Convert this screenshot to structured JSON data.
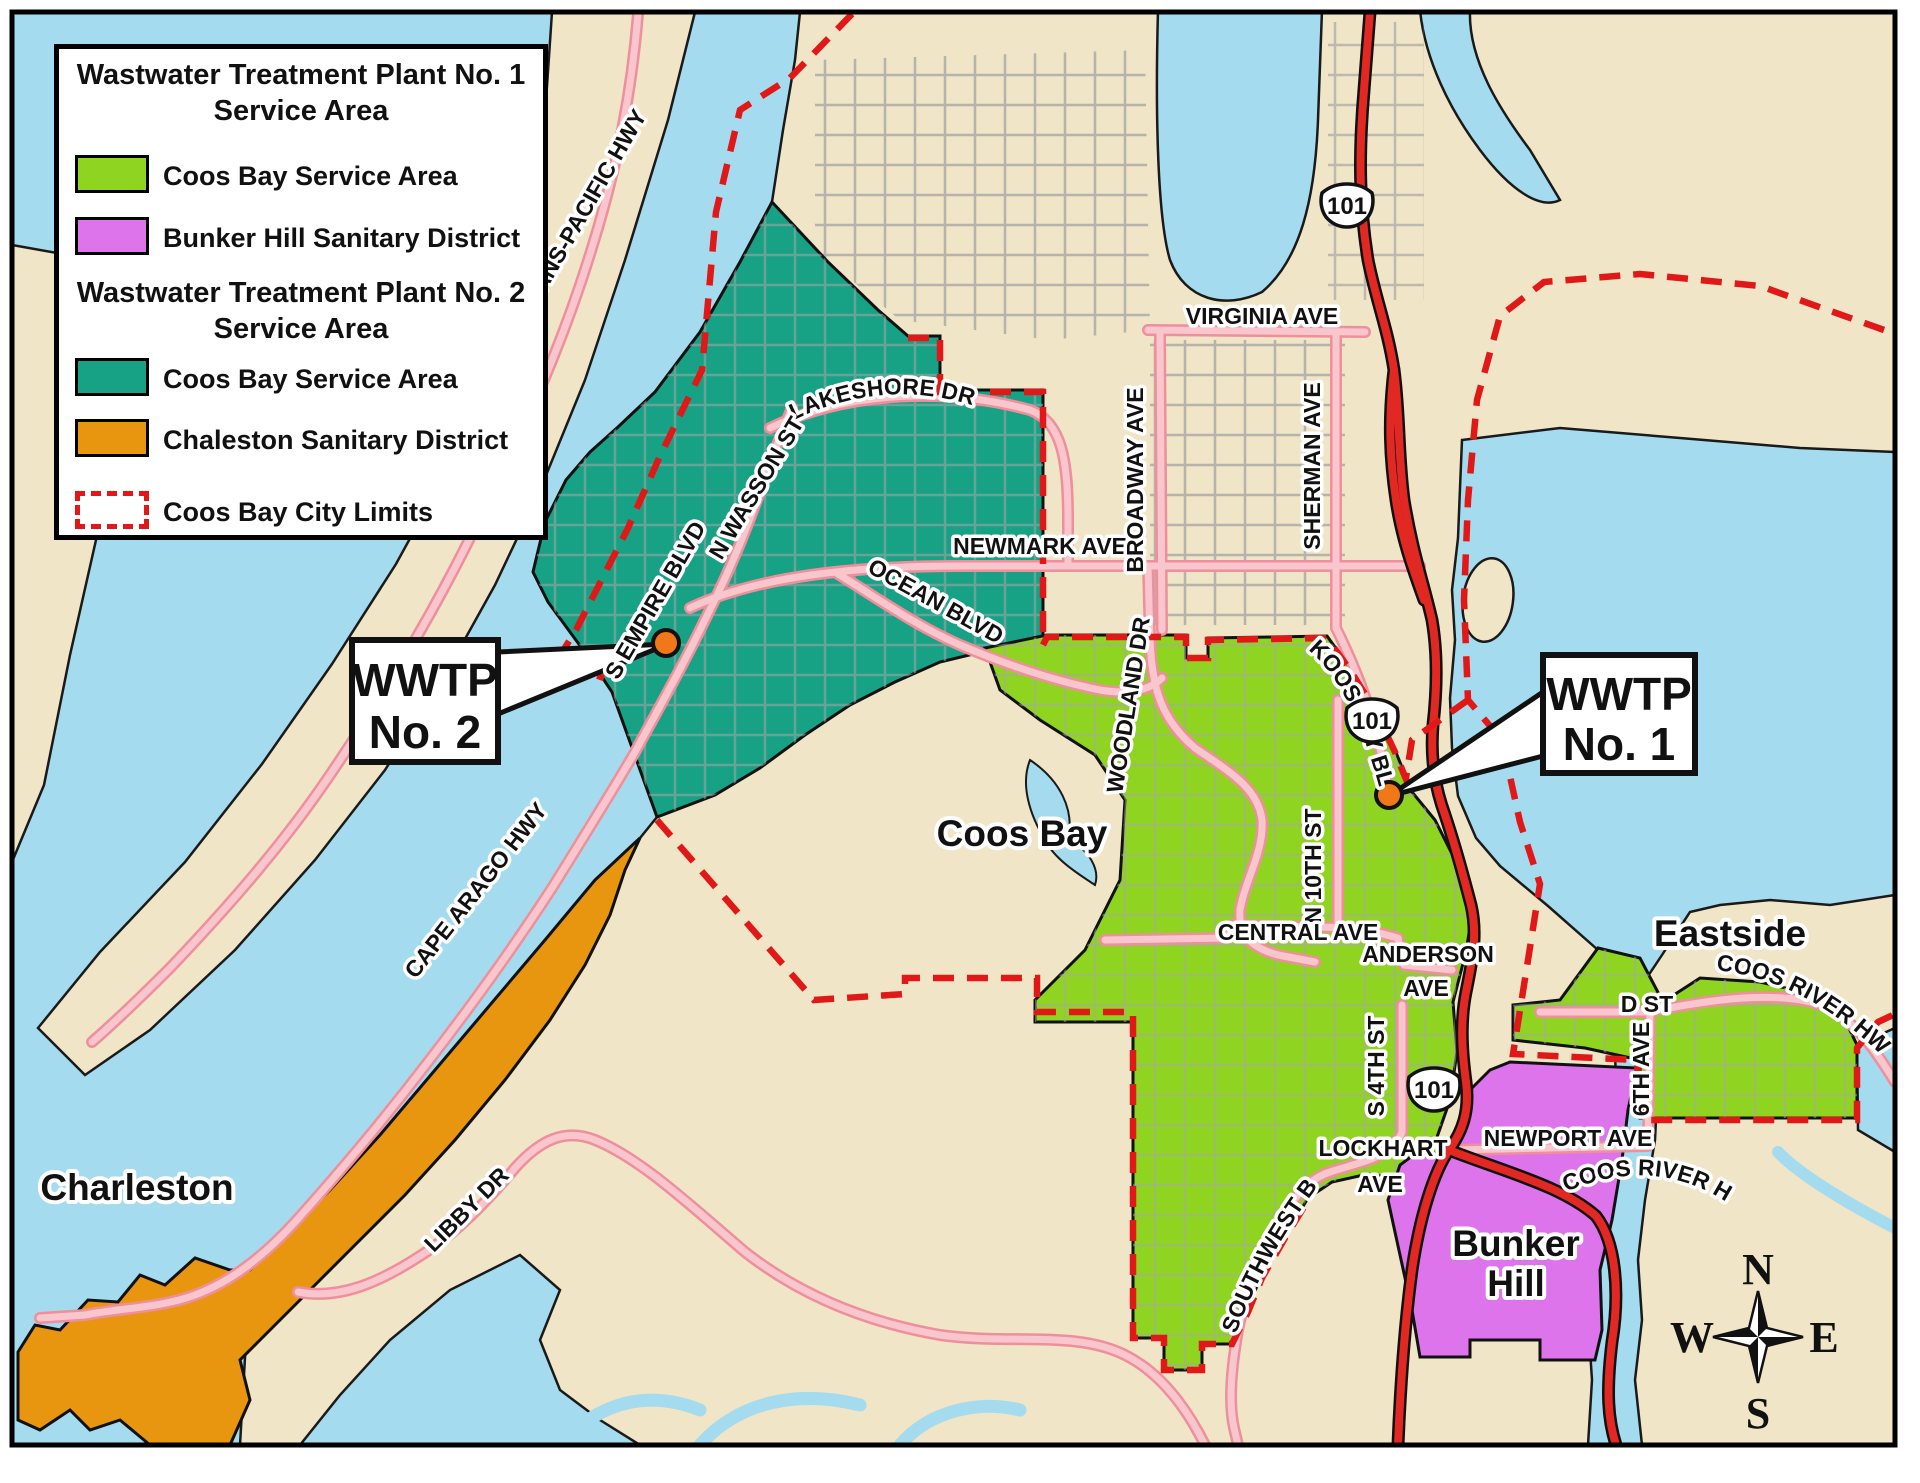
{
  "legend": {
    "wwtp1_title_line1": "Wastwater Treatment Plant No. 1",
    "wwtp1_title_line2": "Service Area",
    "item_coos_bay_1": "Coos Bay Service Area",
    "item_bunker_hill": "Bunker Hill Sanitary District",
    "wwtp2_title_line1": "Wastwater Treatment Plant No. 2",
    "wwtp2_title_line2": "Service Area",
    "item_coos_bay_2": "Coos Bay Service Area",
    "item_chaleston": "Chaleston Sanitary District",
    "item_city_limits": "Coos Bay City Limits"
  },
  "colors": {
    "coos_bay_service_area_wwtp1": "#8FD420",
    "bunker_hill_sanitary_district": "#DD74EC",
    "coos_bay_service_area_wwtp2": "#17A185",
    "chaleston_sanitary_district": "#E8960F",
    "coos_bay_city_limits_dash": "#E01818",
    "water": "#A5DBEF",
    "land": "#F0E5C6",
    "highway_red": "#E22822",
    "road_pink": "#F9C6CD",
    "wwtp_marker_orange": "#F07818"
  },
  "callouts": {
    "wwtp1_line1": "WWTP",
    "wwtp1_line2": "No. 1",
    "wwtp2_line1": "WWTP",
    "wwtp2_line2": "No. 2"
  },
  "places": {
    "coos_bay": "Coos Bay",
    "charleston": "Charleston",
    "eastside": "Eastside",
    "bunker_hill_line1": "Bunker",
    "bunker_hill_line2": "Hill"
  },
  "roads": {
    "trans_pacific": "TRANS-PACIFIC HWY",
    "lakeshore": "LAKESHORE DR",
    "n_wasson": "N WASSON ST",
    "s_empire": "S EMPIRE BLVD",
    "newmark": "NEWMARK AVE",
    "ocean": "OCEAN BLVD",
    "virginia": "VIRGINIA AVE",
    "broadway": "BROADWAY AVE",
    "sherman": "SHERMAN AVE",
    "woodland": "WOODLAND DR",
    "koos_bay": "KOOS BAY BLVD",
    "n_10th": "N 10TH ST",
    "central": "CENTRAL AVE",
    "anderson_line1": "ANDERSON",
    "anderson_line2": "AVE",
    "s_4th": "S 4TH ST",
    "lockhart_line1": "LOCKHART",
    "lockhart_line2": "AVE",
    "southwest": "SOUTHWEST BLVD",
    "newport": "NEWPORT AVE",
    "coos_river_upper": "COOS RIVER HWY",
    "coos_river_lower": "COOS RIVER HWY",
    "d_st": "D ST",
    "sixth_ave": "6TH AVE",
    "cape_arago": "CAPE ARAGO HWY",
    "libby": "LIBBY DR"
  },
  "highway_shield": "101",
  "compass": {
    "north": "N",
    "east": "E",
    "south": "S",
    "west": "W"
  }
}
